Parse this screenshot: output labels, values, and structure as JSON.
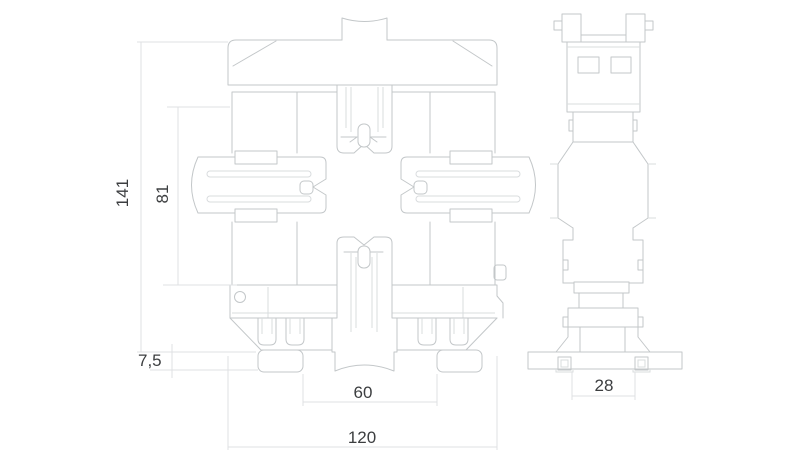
{
  "colors": {
    "background": "#ffffff",
    "outline": "#c3c7c9",
    "detail_line": "#d9dcde",
    "dimension_line": "#dfe1e3",
    "dimension_text": "#3c3e40"
  },
  "views": {
    "front": {
      "name": "front-view"
    },
    "side": {
      "name": "side-view"
    }
  },
  "dimensions": {
    "overall_height": "141",
    "upper_body_height": "81",
    "foot_height": "7,5",
    "foot_spacing": "60",
    "overall_width": "120",
    "base_width": "28"
  }
}
